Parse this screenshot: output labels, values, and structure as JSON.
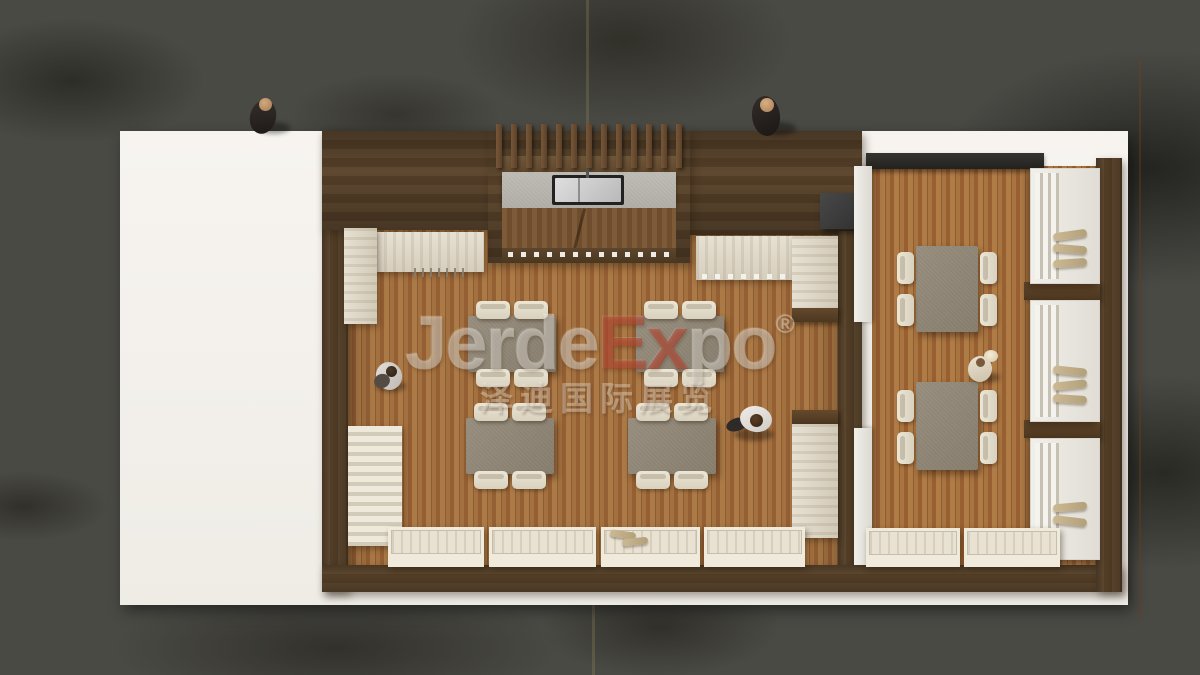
{
  "watermark": {
    "part1": "Jerde",
    "part2": "Ex",
    "part3": "po",
    "registered": "®",
    "subtitle": "泽迪国际展览",
    "accent_color": "#ba3c26"
  },
  "scene": {
    "type": "top-down 3d render",
    "subject": "wooden exhibition booth restaurant on white platform over concrete floor",
    "rooms": [
      {
        "name": "main-dining-room",
        "tables": 4,
        "chairs_per_table": 4,
        "wall_display_benches": 4,
        "kitchen_counter": 1
      },
      {
        "name": "side-dining-room",
        "tables": 2,
        "chairs_per_table": 4,
        "display_shelf_units": 3,
        "wall_display_benches": 2
      }
    ],
    "people_count": 5
  },
  "palette": {
    "concrete": "#4a4a45",
    "platform_white": "#f5f2ed",
    "wall_wood": "#5a4530",
    "floor_wood": "#9c6b40",
    "travertine": "#e0d9cb",
    "table_top": "#8e8576",
    "chair_cream": "#eae4d3",
    "counter_gray": "#b7b4ae",
    "black_box": "#3c3c3c"
  }
}
